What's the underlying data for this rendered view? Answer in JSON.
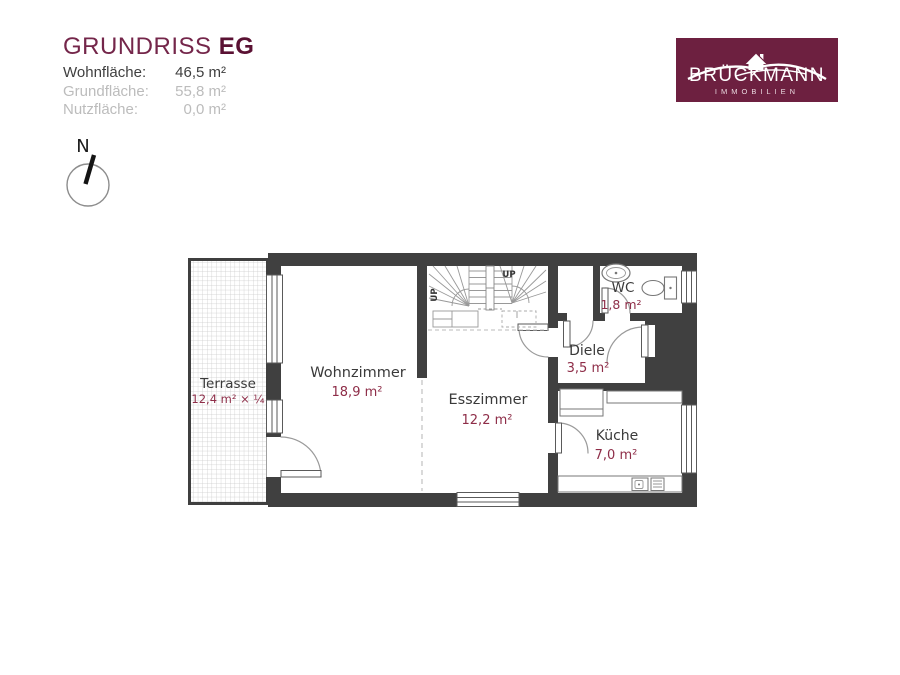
{
  "header": {
    "title": "GRUNDRISS",
    "title_suffix": "EG",
    "metrics": [
      {
        "label": "Wohnfläche:",
        "value": "46,5 m²"
      },
      {
        "label": "Grundfläche:",
        "value": "55,8 m²"
      },
      {
        "label": "Nutzfläche:",
        "value": "0,0 m²"
      }
    ]
  },
  "logo": {
    "brand": "BRÜCKMANN",
    "subtitle": "IMMOBILIEN",
    "bg_color": "#6d2040"
  },
  "compass": {
    "north_label": "N"
  },
  "plan": {
    "rooms": [
      {
        "id": "terrasse",
        "name": "Terrasse",
        "area": "12,4 m² × ¼"
      },
      {
        "id": "wohnzimmer",
        "name": "Wohnzimmer",
        "area": "18,9 m²"
      },
      {
        "id": "esszimmer",
        "name": "Esszimmer",
        "area": "12,2 m²"
      },
      {
        "id": "diele",
        "name": "Diele",
        "area": "3,5 m²"
      },
      {
        "id": "wc",
        "name": "WC",
        "area": "1,8 m²"
      },
      {
        "id": "kueche",
        "name": "Küche",
        "area": "7,0 m²"
      }
    ],
    "stairs": {
      "up_label_top": "UP",
      "up_label_left": "UP"
    }
  },
  "colors": {
    "wall": "#404040",
    "brand_burgundy": "#6d2040",
    "area_value_red": "#8e2d48",
    "muted_text": "#bcbcbc"
  }
}
